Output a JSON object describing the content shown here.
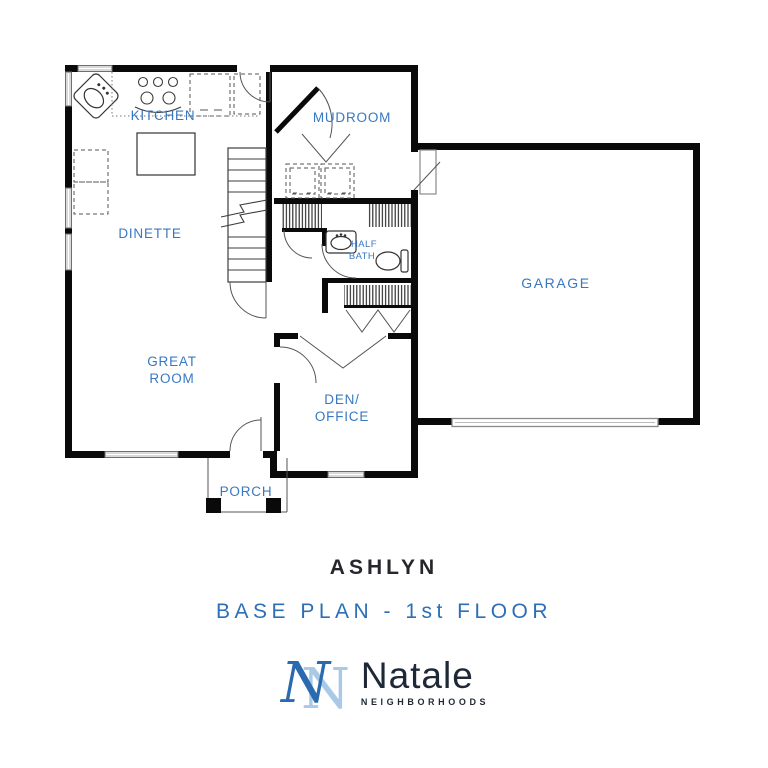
{
  "plan": {
    "rooms": {
      "kitchen": "KITCHEN",
      "dinette": "DINETTE",
      "mudroom": "MUDROOM",
      "half_bath_line1": "HALF",
      "half_bath_line2": "BATH",
      "garage": "GARAGE",
      "great_room_line1": "GREAT",
      "great_room_line2": "ROOM",
      "den_office_line1": "DEN/",
      "den_office_line2": "OFFICE",
      "porch": "PORCH"
    }
  },
  "footer": {
    "plan_name": "ASHLYN",
    "subtitle": "BASE PLAN - 1st FLOOR",
    "brand": "Natale",
    "brand_tagline": "NEIGHBORHOODS",
    "monogram_letter": "N"
  },
  "colors": {
    "label_blue": "#3878C2",
    "title_dark": "#26262C",
    "subtitle_blue": "#2D6FB7",
    "brand_navy": "#1E2836",
    "monogram_dark": "#2A6BB0",
    "monogram_light": "#A9C9E6",
    "wall_black": "#0A0A0A"
  }
}
